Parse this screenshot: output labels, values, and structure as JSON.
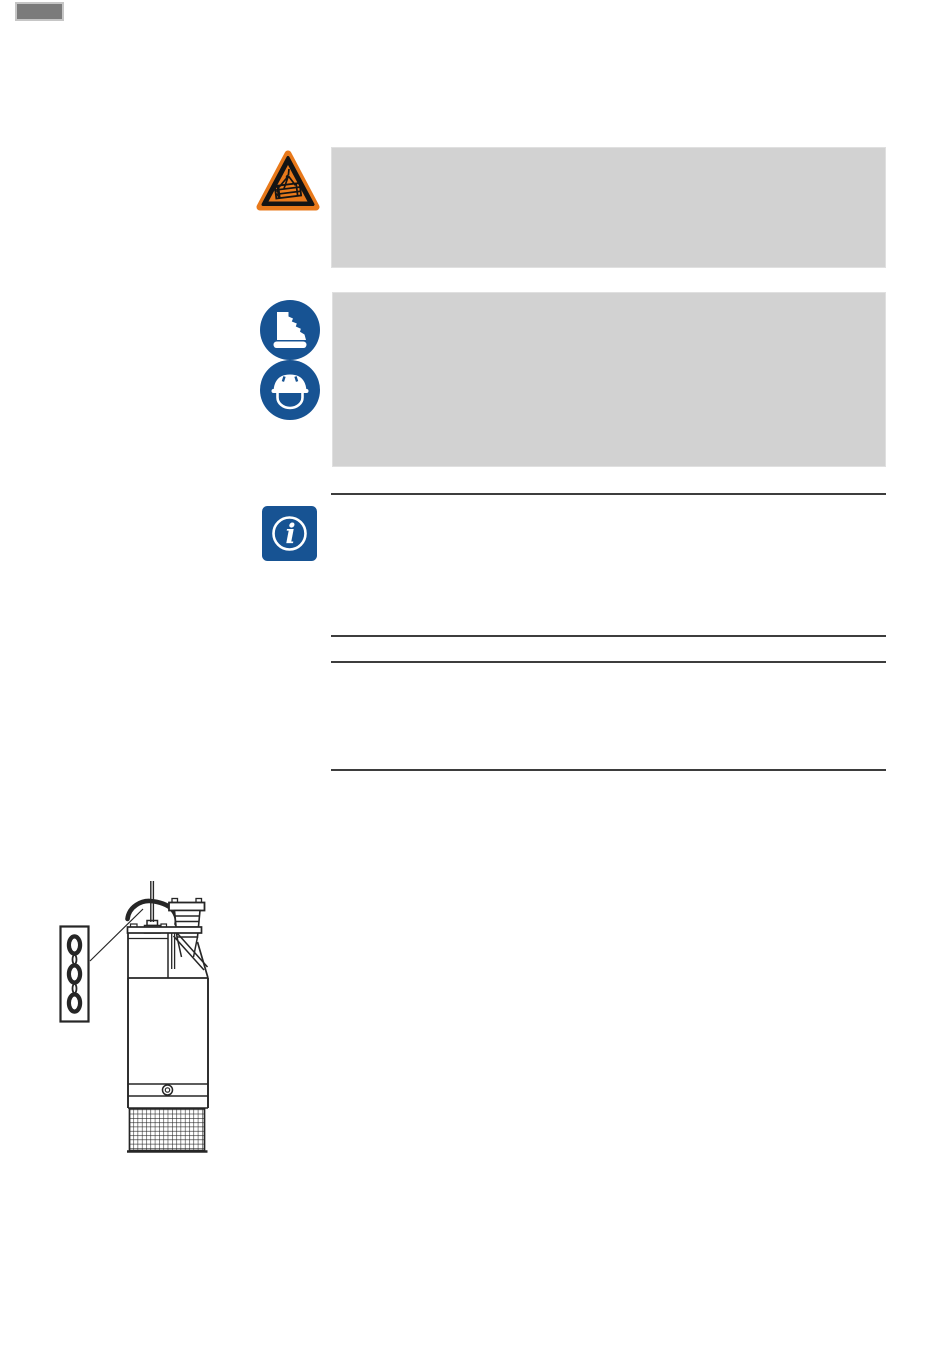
{
  "page": {
    "kind": "instruction-manual-page",
    "width": 950,
    "height": 1369,
    "background": "#ffffff",
    "visible_text": ""
  },
  "page_tab": {
    "fill": "#7b7b7b",
    "border": "#c6c6c6"
  },
  "colors": {
    "notice_box_gray": "#d2d2d2",
    "rule_dark": "#3d3d3d",
    "safety_orange": "#e8791b",
    "safety_blue": "#175393",
    "pictogram_black": "#141414",
    "drawing_ink": "#262626"
  },
  "icons": {
    "warning": {
      "name": "suspended-load-warning-icon",
      "label": "warning: suspended load"
    },
    "boots": {
      "name": "safety-boots-icon",
      "label": "wear safety footwear"
    },
    "helmet": {
      "name": "safety-helmet-icon",
      "label": "wear protective helmet"
    },
    "info": {
      "name": "info-icon",
      "label": "notice / information"
    }
  },
  "sections": [
    {
      "kind": "warning-notice",
      "presentation": "gray-box",
      "icons": [
        "suspended-load-warning-icon"
      ],
      "text": ""
    },
    {
      "kind": "mandatory-ppe-notice",
      "presentation": "gray-box",
      "icons": [
        "safety-boots-icon",
        "safety-helmet-icon"
      ],
      "text": ""
    },
    {
      "kind": "info-notice",
      "presentation": "ruled-section",
      "icons": [
        "info-icon"
      ],
      "text": ""
    },
    {
      "kind": "text-section",
      "presentation": "ruled-section",
      "icons": [],
      "text": ""
    }
  ],
  "figure": {
    "name": "submersible-pump-lifting-figure",
    "parts": [
      "chain-detail-box",
      "chain-links",
      "leader-line",
      "power-cable",
      "carrying-handle",
      "discharge-hose-coupling",
      "motor-housing",
      "pump-body",
      "drain-screw",
      "suction-strainer"
    ]
  }
}
